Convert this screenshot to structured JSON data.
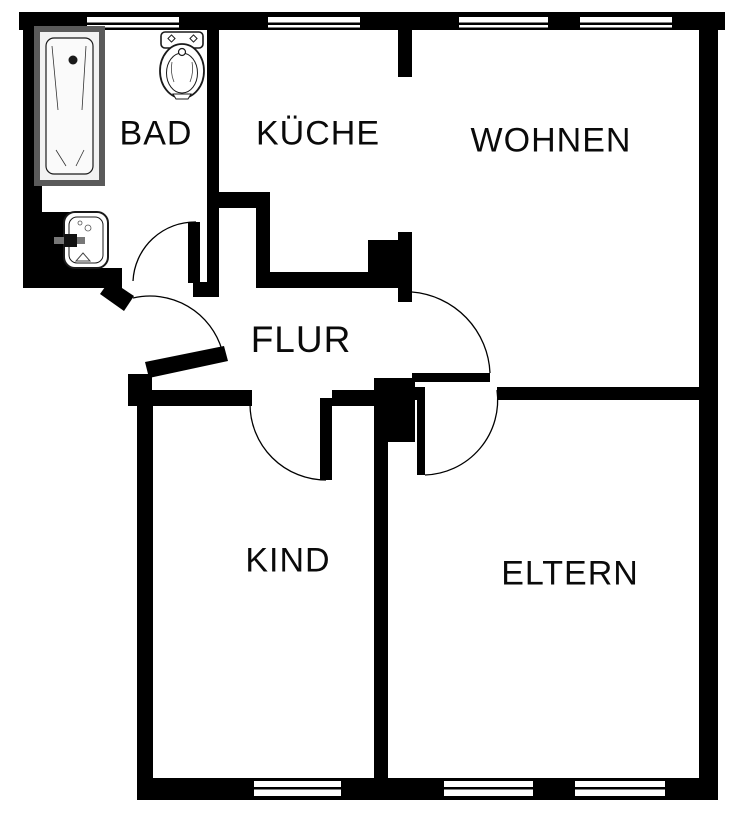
{
  "plan": {
    "type": "apartment-floor-plan",
    "background_color": "#ffffff",
    "wall_color": "#000000",
    "bathtub_rim_color": "#5a5a5a",
    "door_swing_count": 5,
    "window_count_top": 4,
    "window_count_bottom": 3
  },
  "rooms": [
    {
      "id": "bad",
      "label": "BAD"
    },
    {
      "id": "kueche",
      "label": "KÜCHE"
    },
    {
      "id": "wohnen",
      "label": "WOHNEN"
    },
    {
      "id": "flur",
      "label": "FLUR"
    },
    {
      "id": "kind",
      "label": "KIND"
    },
    {
      "id": "eltern",
      "label": "ELTERN"
    }
  ],
  "fixtures": [
    {
      "name": "bathtub-icon",
      "room": "BAD"
    },
    {
      "name": "toilet-icon",
      "room": "BAD"
    },
    {
      "name": "sink-icon",
      "room": "BAD"
    }
  ]
}
